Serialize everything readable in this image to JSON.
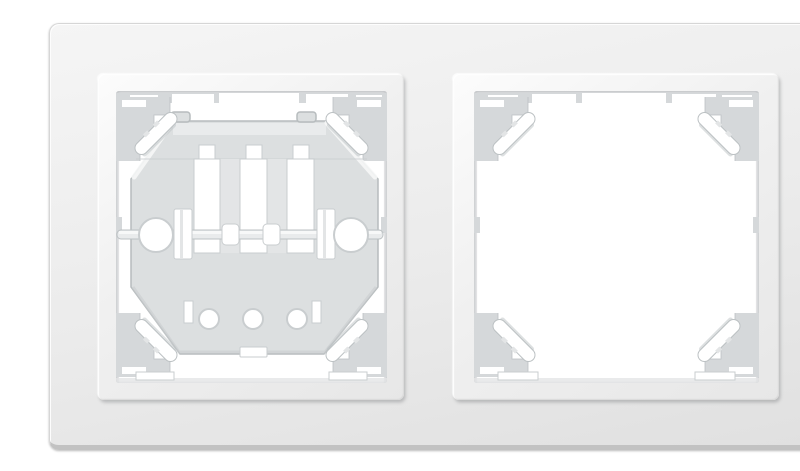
{
  "scene": {
    "type": "product-photo",
    "description": "White plastic two-gang horizontal wall frame for electrical switches and sockets on a white background; the left square window is fitted with an octagonal mounting claw mechanism with a horizontal adjustment shaft, two large side screw holes and three small bottom holes; the right square window is empty showing four corner fixing clips",
    "object_label": "2-gang switch/socket wall frame, white",
    "background": "#ffffff"
  },
  "colors": {
    "bg": "#ffffff",
    "plate_top": "#f5f5f5",
    "plate_mid": "#ebebeb",
    "plate_bottom": "#e0e0e0",
    "plate_edge": "#d6d6d6",
    "plate_rim": "#c2c2c2",
    "surround_light": "#fcfcfc",
    "surround_dark": "#e7e7e7",
    "bevel_shadow": "#c7c7c7",
    "opening_white": "#ffffff",
    "wall_gray": "#d5d8da",
    "wall_gray_2": "#e3e5e6",
    "wall_edge": "#bcc1c3",
    "mech_face": "#dcdfe0",
    "mech_light": "#e9ebec",
    "mech_edge": "#b7bcbe",
    "shadow_line": "#c9cdcf"
  },
  "parts": {
    "outer_plate": "Outer frame plate",
    "left_surround": "Left window surround (beveled)",
    "right_surround": "Right window surround (beveled)",
    "left_opening": "Left window opening with mounting mechanism",
    "right_opening": "Empty right window opening",
    "mechanism": "Octagonal mounting claw plate",
    "shaft": "Claw adjustment shaft",
    "screw_hole": "Screw hole",
    "corner_clip": "Corner fixing clip",
    "top_wall": "Inner top wall with notches"
  }
}
